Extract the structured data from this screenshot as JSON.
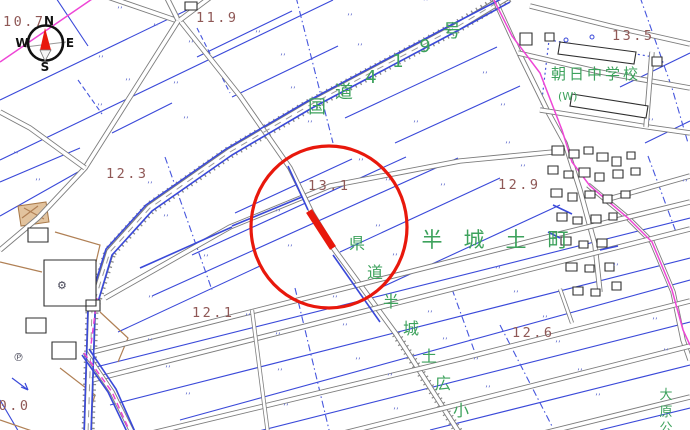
{
  "map": {
    "type": "japanese-cadastral-map-view",
    "colors": {
      "parcel_blue": "#3a49d9",
      "road_gray": "#7d7d7d",
      "boundary_magenta": "#ee46d6",
      "label_green": "#3da25c",
      "elevation_brown": "#8f5856",
      "annotation_red": "#e8180c",
      "building_black": "#2f2f2f",
      "path_brown": "#b08055"
    },
    "compass": {
      "north": "N",
      "east": "E",
      "south": "S",
      "west": "W"
    },
    "elevation_points": [
      {
        "value": "10.7",
        "x": 3,
        "y": 26
      },
      {
        "value": "11.9",
        "x": 196,
        "y": 22
      },
      {
        "value": "13.5",
        "x": 612,
        "y": 40
      },
      {
        "value": "12.3",
        "x": 106,
        "y": 178
      },
      {
        "value": "13.1",
        "x": 308,
        "y": 190
      },
      {
        "value": "12.9",
        "x": 498,
        "y": 189
      },
      {
        "value": "12.1",
        "x": 192,
        "y": 317
      },
      {
        "value": "12.6",
        "x": 512,
        "y": 337
      },
      {
        "value": "10.0",
        "x": -12,
        "y": 410
      }
    ],
    "road_labels": {
      "route419": {
        "text": "国道419号",
        "chars": [
          {
            "c": "国",
            "x": 317,
            "y": 113
          },
          {
            "c": "道",
            "x": 344,
            "y": 98
          },
          {
            "c": "4",
            "x": 371,
            "y": 83
          },
          {
            "c": "1",
            "x": 398,
            "y": 67
          },
          {
            "c": "9",
            "x": 425,
            "y": 52
          },
          {
            "c": "号",
            "x": 452,
            "y": 37
          }
        ],
        "size": 18
      },
      "pref_road": {
        "text": "県道半城土広小",
        "chars": [
          {
            "c": "県",
            "x": 357,
            "y": 249
          },
          {
            "c": "道",
            "x": 375,
            "y": 278
          },
          {
            "c": "半",
            "x": 391,
            "y": 307
          },
          {
            "c": "城",
            "x": 411,
            "y": 334
          },
          {
            "c": "土",
            "x": 429,
            "y": 362
          },
          {
            "c": "広",
            "x": 443,
            "y": 389
          },
          {
            "c": "小",
            "x": 461,
            "y": 416
          }
        ],
        "size": 16
      }
    },
    "area_labels": {
      "town": {
        "text": "半城土町",
        "chars": [
          {
            "c": "半",
            "x": 432,
            "y": 247
          },
          {
            "c": "城",
            "x": 474,
            "y": 247
          },
          {
            "c": "土",
            "x": 516,
            "y": 247
          },
          {
            "c": "町",
            "x": 558,
            "y": 247
          }
        ],
        "size": 21
      },
      "school": {
        "text": "朝日中学校",
        "x": 551,
        "y": 79,
        "size": 15
      },
      "school_well": "(W)",
      "park": {
        "text": "大原公",
        "chars": [
          {
            "c": "大",
            "x": 666,
            "y": 399
          },
          {
            "c": "原",
            "x": 666,
            "y": 416
          },
          {
            "c": "公",
            "x": 666,
            "y": 432
          }
        ],
        "size": 13
      }
    },
    "symbols": {
      "parking": "℗",
      "factory": "⚙",
      "paddy": "’’"
    },
    "paddy_marks": [
      [
        117,
        13
      ],
      [
        153,
        30
      ],
      [
        188,
        47
      ],
      [
        98,
        62
      ],
      [
        125,
        85
      ],
      [
        97,
        110
      ],
      [
        183,
        123
      ],
      [
        173,
        88
      ],
      [
        347,
        20
      ],
      [
        255,
        37
      ],
      [
        423,
        5
      ],
      [
        280,
        60
      ],
      [
        357,
        50
      ],
      [
        290,
        93
      ],
      [
        307,
        127
      ],
      [
        413,
        127
      ],
      [
        448,
        35
      ],
      [
        482,
        78
      ],
      [
        500,
        110
      ],
      [
        648,
        125
      ],
      [
        13,
        158
      ],
      [
        35,
        185
      ],
      [
        147,
        188
      ],
      [
        163,
        221
      ],
      [
        203,
        261
      ],
      [
        275,
        216
      ],
      [
        287,
        251
      ],
      [
        358,
        165
      ],
      [
        385,
        185
      ],
      [
        440,
        190
      ],
      [
        375,
        231
      ],
      [
        392,
        260
      ],
      [
        505,
        148
      ],
      [
        520,
        171
      ],
      [
        682,
        186
      ],
      [
        613,
        270
      ],
      [
        495,
        273
      ],
      [
        148,
        302
      ],
      [
        147,
        345
      ],
      [
        165,
        372
      ],
      [
        185,
        399
      ],
      [
        332,
        302
      ],
      [
        245,
        320
      ],
      [
        275,
        339
      ],
      [
        342,
        330
      ],
      [
        427,
        317
      ],
      [
        277,
        375
      ],
      [
        355,
        364
      ],
      [
        387,
        380
      ],
      [
        442,
        344
      ],
      [
        283,
        410
      ],
      [
        393,
        414
      ],
      [
        513,
        297
      ],
      [
        542,
        322
      ],
      [
        652,
        324
      ],
      [
        555,
        347
      ],
      [
        473,
        364
      ],
      [
        577,
        375
      ],
      [
        485,
        392
      ],
      [
        663,
        355
      ],
      [
        595,
        400
      ]
    ]
  }
}
